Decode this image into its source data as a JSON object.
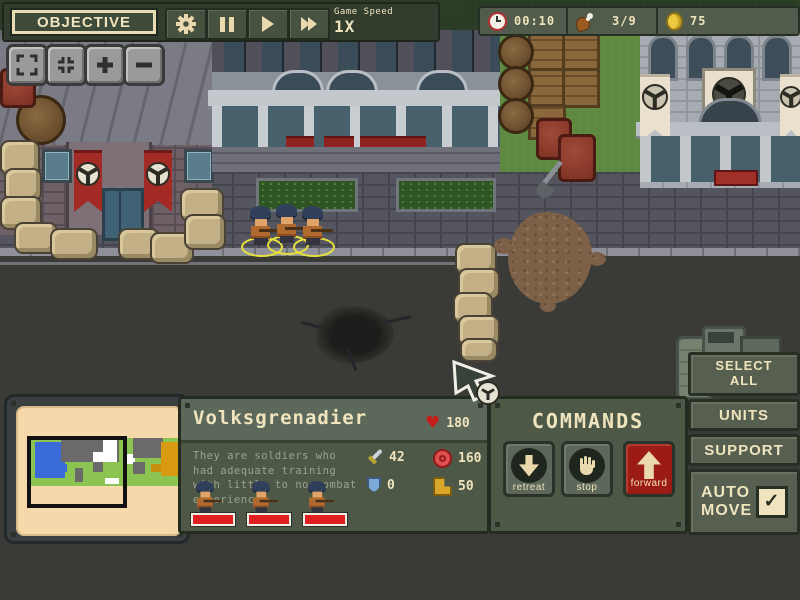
{
  "colors": {
    "panel_green": "#4d5847",
    "panel_green_light": "#5c685a",
    "hud_dark_green": "#323d2e",
    "cream_text": "#efe4bd",
    "accent_red": "#9c1c15",
    "health_red": "#e02020",
    "selection_yellow": "#e6e03c",
    "minimap_paper": "#f6d9ab"
  },
  "top_bar": {
    "objective_label": "OBJECTIVE",
    "game_speed_label": "Game Speed",
    "game_speed_value": "1X"
  },
  "resources": {
    "time": "00:10",
    "food": "3/9",
    "gold": "75"
  },
  "unit_panel": {
    "name": "Volksgrenadier",
    "hp": "180",
    "description": "They are soldiers who had adequate training with little to no combat experience",
    "attack": "42",
    "range": "160",
    "armor": "0",
    "speed": "50",
    "unit_count": 3
  },
  "commands_panel": {
    "title": "COMMANDS",
    "retreat": "retreat",
    "stop": "stop",
    "forward": "forward"
  },
  "side_panel": {
    "select_all_line1": "SELECT",
    "select_all_line2": "ALL",
    "units": "UNITS",
    "support": "SUPPORT",
    "auto_line1": "AUTO",
    "auto_line2": "MOVE",
    "auto_move_checked": true
  },
  "icons": {
    "heart": "♥",
    "check": "✓"
  }
}
